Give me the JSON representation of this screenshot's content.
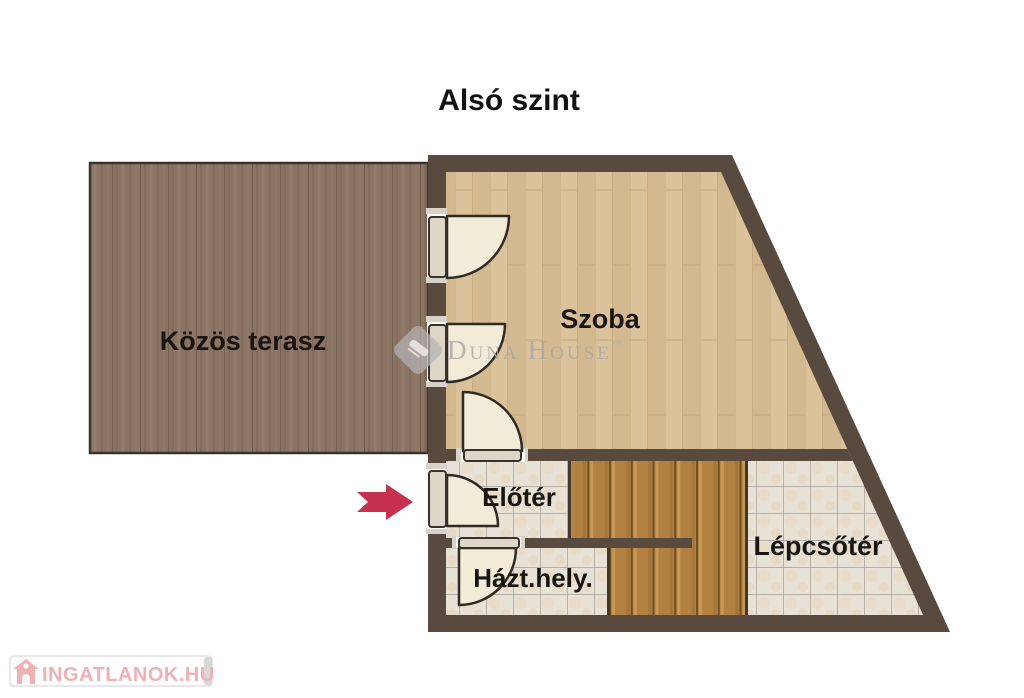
{
  "title": "Alsó szint",
  "rooms": {
    "terrace": {
      "label": "Közös terasz"
    },
    "szoba": {
      "label": "Szoba"
    },
    "eloter": {
      "label": "Előtér"
    },
    "hazthely": {
      "label": "Házt.hely."
    },
    "lepcsoter": {
      "label": "Lépcsőtér"
    }
  },
  "watermark": {
    "part_d": "D",
    "part_una": "UNA",
    "part_h": "H",
    "part_ouse": "OUSE",
    "trademark": "™",
    "logo": "duna-house-diamond-logo"
  },
  "branding": {
    "site_name": "INGATLANOK.HU",
    "icon": "house-icon"
  },
  "entrance_arrow": {
    "icon": "entrance-arrow-icon",
    "direction": "right"
  },
  "colors": {
    "wall": "#584a3e",
    "wall_dark_edge": "#3a322b",
    "terrace_wood": "#8b7463",
    "room_wood": "#dac29a",
    "stair_wood": "#b28040",
    "tile": "#e7e1d6",
    "door_cream": "#f2ebd8",
    "arrow": "#c5314f",
    "brand_pink": "#f1b0b4",
    "watermark_gray": "#a9a7a9"
  }
}
